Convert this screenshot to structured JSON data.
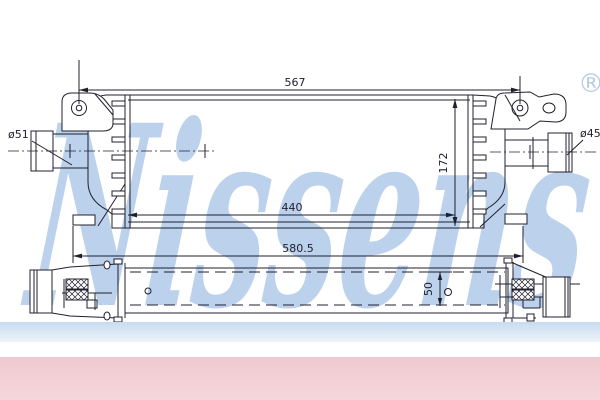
{
  "watermark": {
    "brand": "Nissens",
    "registered_mark": "®",
    "color": "#bcd1ec"
  },
  "drawing": {
    "line_color": "#20202e",
    "dimensions": {
      "mounting_width": "567",
      "core_width": "440",
      "overall_width": "580.5",
      "core_height": "172",
      "depth": "50",
      "left_port_diameter": "ø51",
      "right_port_diameter": "ø45"
    }
  },
  "footer": {
    "blue_band_color": "#c7dbf0",
    "pink_band_color": "#f2ced4"
  }
}
